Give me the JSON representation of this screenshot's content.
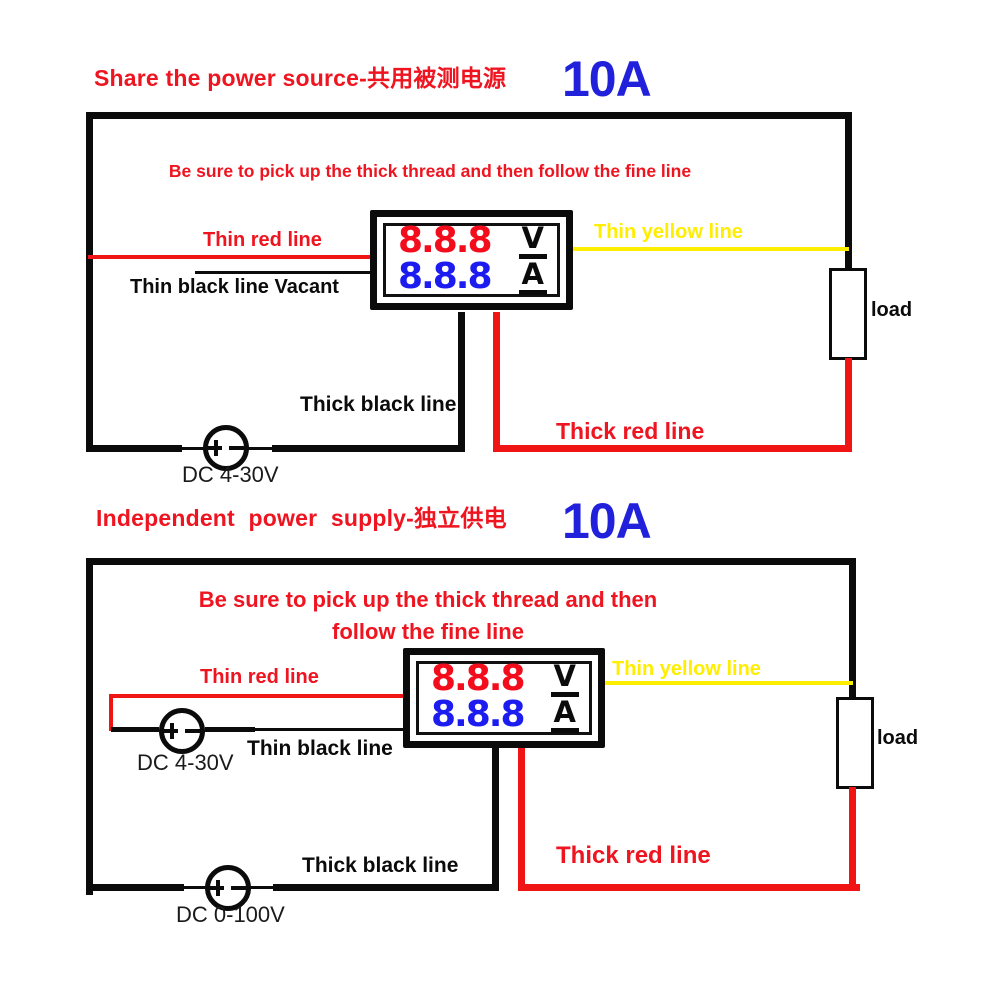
{
  "colors": {
    "wire_black": "#0b0b0b",
    "wire_red": "#f11414",
    "wire_yellow": "#fcee00",
    "text_red": "#ee1420",
    "text_blue": "#2121dc",
    "digit_red": "#f30d1c",
    "digit_blue": "#1c1cf0"
  },
  "top": {
    "title": "Share the power source-共用被测电源",
    "rating": "10A",
    "warning": "Be sure to pick up the thick thread and then follow the fine line",
    "meter": {
      "volts": "8.8.8",
      "volt_unit": "V",
      "amps": "8.8.8",
      "amp_unit": "A"
    },
    "labels": {
      "thin_red": "Thin red line",
      "thin_black": "Thin black line Vacant",
      "thin_yellow": "Thin yellow line",
      "thick_black": "Thick black line",
      "thick_red": "Thick red line",
      "load": "load",
      "source": "DC 4-30V"
    }
  },
  "bottom": {
    "title": "Independent power supply-独立供电",
    "rating": "10A",
    "warning_line1": "Be sure to pick up the thick thread and then",
    "warning_line2": "follow the fine line",
    "meter": {
      "volts": "8.8.8",
      "volt_unit": "V",
      "amps": "8.8.8",
      "amp_unit": "A"
    },
    "labels": {
      "thin_red": "Thin red line",
      "thin_black": "Thin black line",
      "thin_yellow": "Thin yellow line",
      "thick_black": "Thick black line",
      "thick_red": "Thick red line",
      "load": "load",
      "source_meter": "DC 4-30V",
      "source_main": "DC 0-100V"
    }
  }
}
